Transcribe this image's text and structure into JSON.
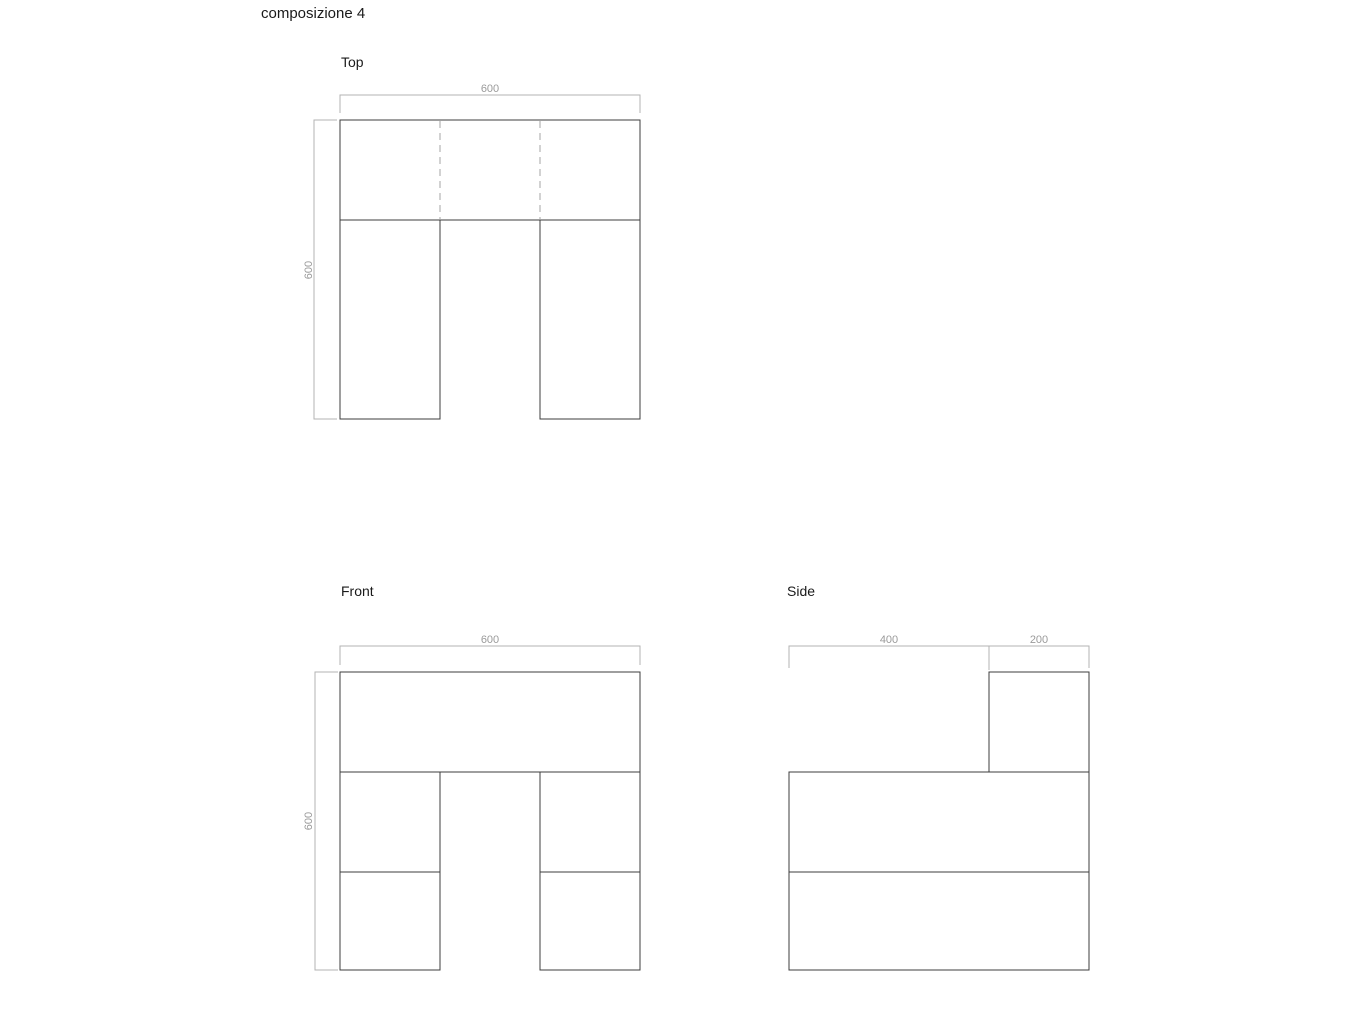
{
  "title": "composizione 4",
  "colors": {
    "background": "#ffffff",
    "outline": "#3c3c3c",
    "dim_line": "#b3b3b3",
    "dim_text": "#9a9a9a",
    "hidden_line": "#a6a6a6",
    "label_text": "#1a1a1a"
  },
  "views": {
    "top": {
      "label": "Top",
      "width_dim": "600",
      "height_dim": "600"
    },
    "front": {
      "label": "Front",
      "width_dim": "600",
      "height_dim": "600"
    },
    "side": {
      "label": "Side",
      "left_dim": "400",
      "right_dim": "200"
    }
  }
}
